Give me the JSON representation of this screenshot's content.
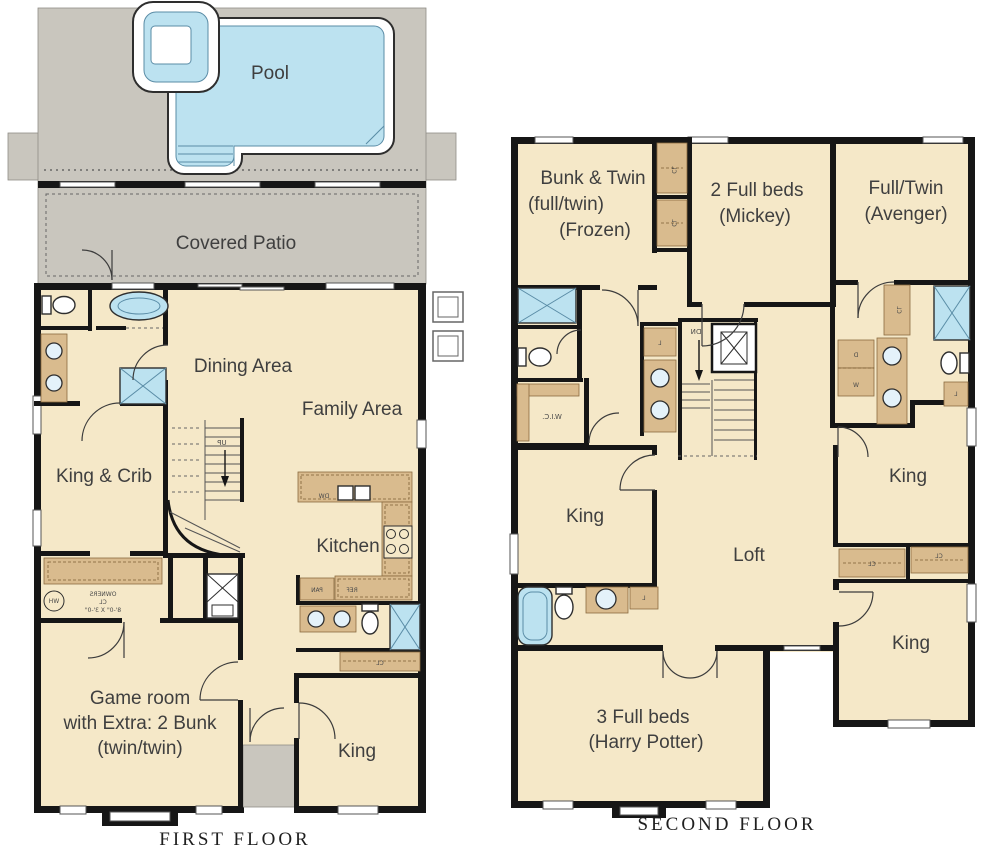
{
  "colors": {
    "wall": "#161616",
    "room": "#f5e8c8",
    "deck": "#c9c6be",
    "pool_water": "#bce2f0",
    "water_stroke": "#5a8ca6",
    "cabinet": "#d9bb8e",
    "cabinet_stroke": "#8a6b40",
    "label_text": "#3f3f3f"
  },
  "first_floor": {
    "title": "FIRST FLOOR",
    "rooms": {
      "pool": "Pool",
      "covered_patio": "Covered Patio",
      "dining": "Dining Area",
      "family": "Family Area",
      "king_crib": "King & Crib",
      "kitchen": "Kitchen",
      "game_room_1": "Game room",
      "game_room_2": "with Extra: 2 Bunk",
      "game_room_3": "(twin/twin)",
      "king": "King"
    },
    "small": {
      "up": "UP",
      "dw": "DW",
      "ref": "REF",
      "pan": "PAN",
      "cl": "CL",
      "owners_1": "OWNERS",
      "owners_2": "CL",
      "owners_3": "8'-0\" X 3'-0\"",
      "wh": "WH"
    }
  },
  "second_floor": {
    "title": "SECOND FLOOR",
    "rooms": {
      "frozen_1": "Bunk & Twin",
      "frozen_2": "(full/twin)",
      "frozen_3": "(Frozen)",
      "mickey_1": "2 Full beds",
      "mickey_2": "(Mickey)",
      "avenger_1": "Full/Twin",
      "avenger_2": "(Avenger)",
      "king_left": "King",
      "loft": "Loft",
      "king_upper_right": "King",
      "king_lower_right": "King",
      "harry_1": "3 Full beds",
      "harry_2": "(Harry Potter)"
    },
    "small": {
      "dn": "DN",
      "wic": "W.I.C.",
      "cl": "CL",
      "l": "L",
      "d": "D",
      "w": "W"
    }
  }
}
